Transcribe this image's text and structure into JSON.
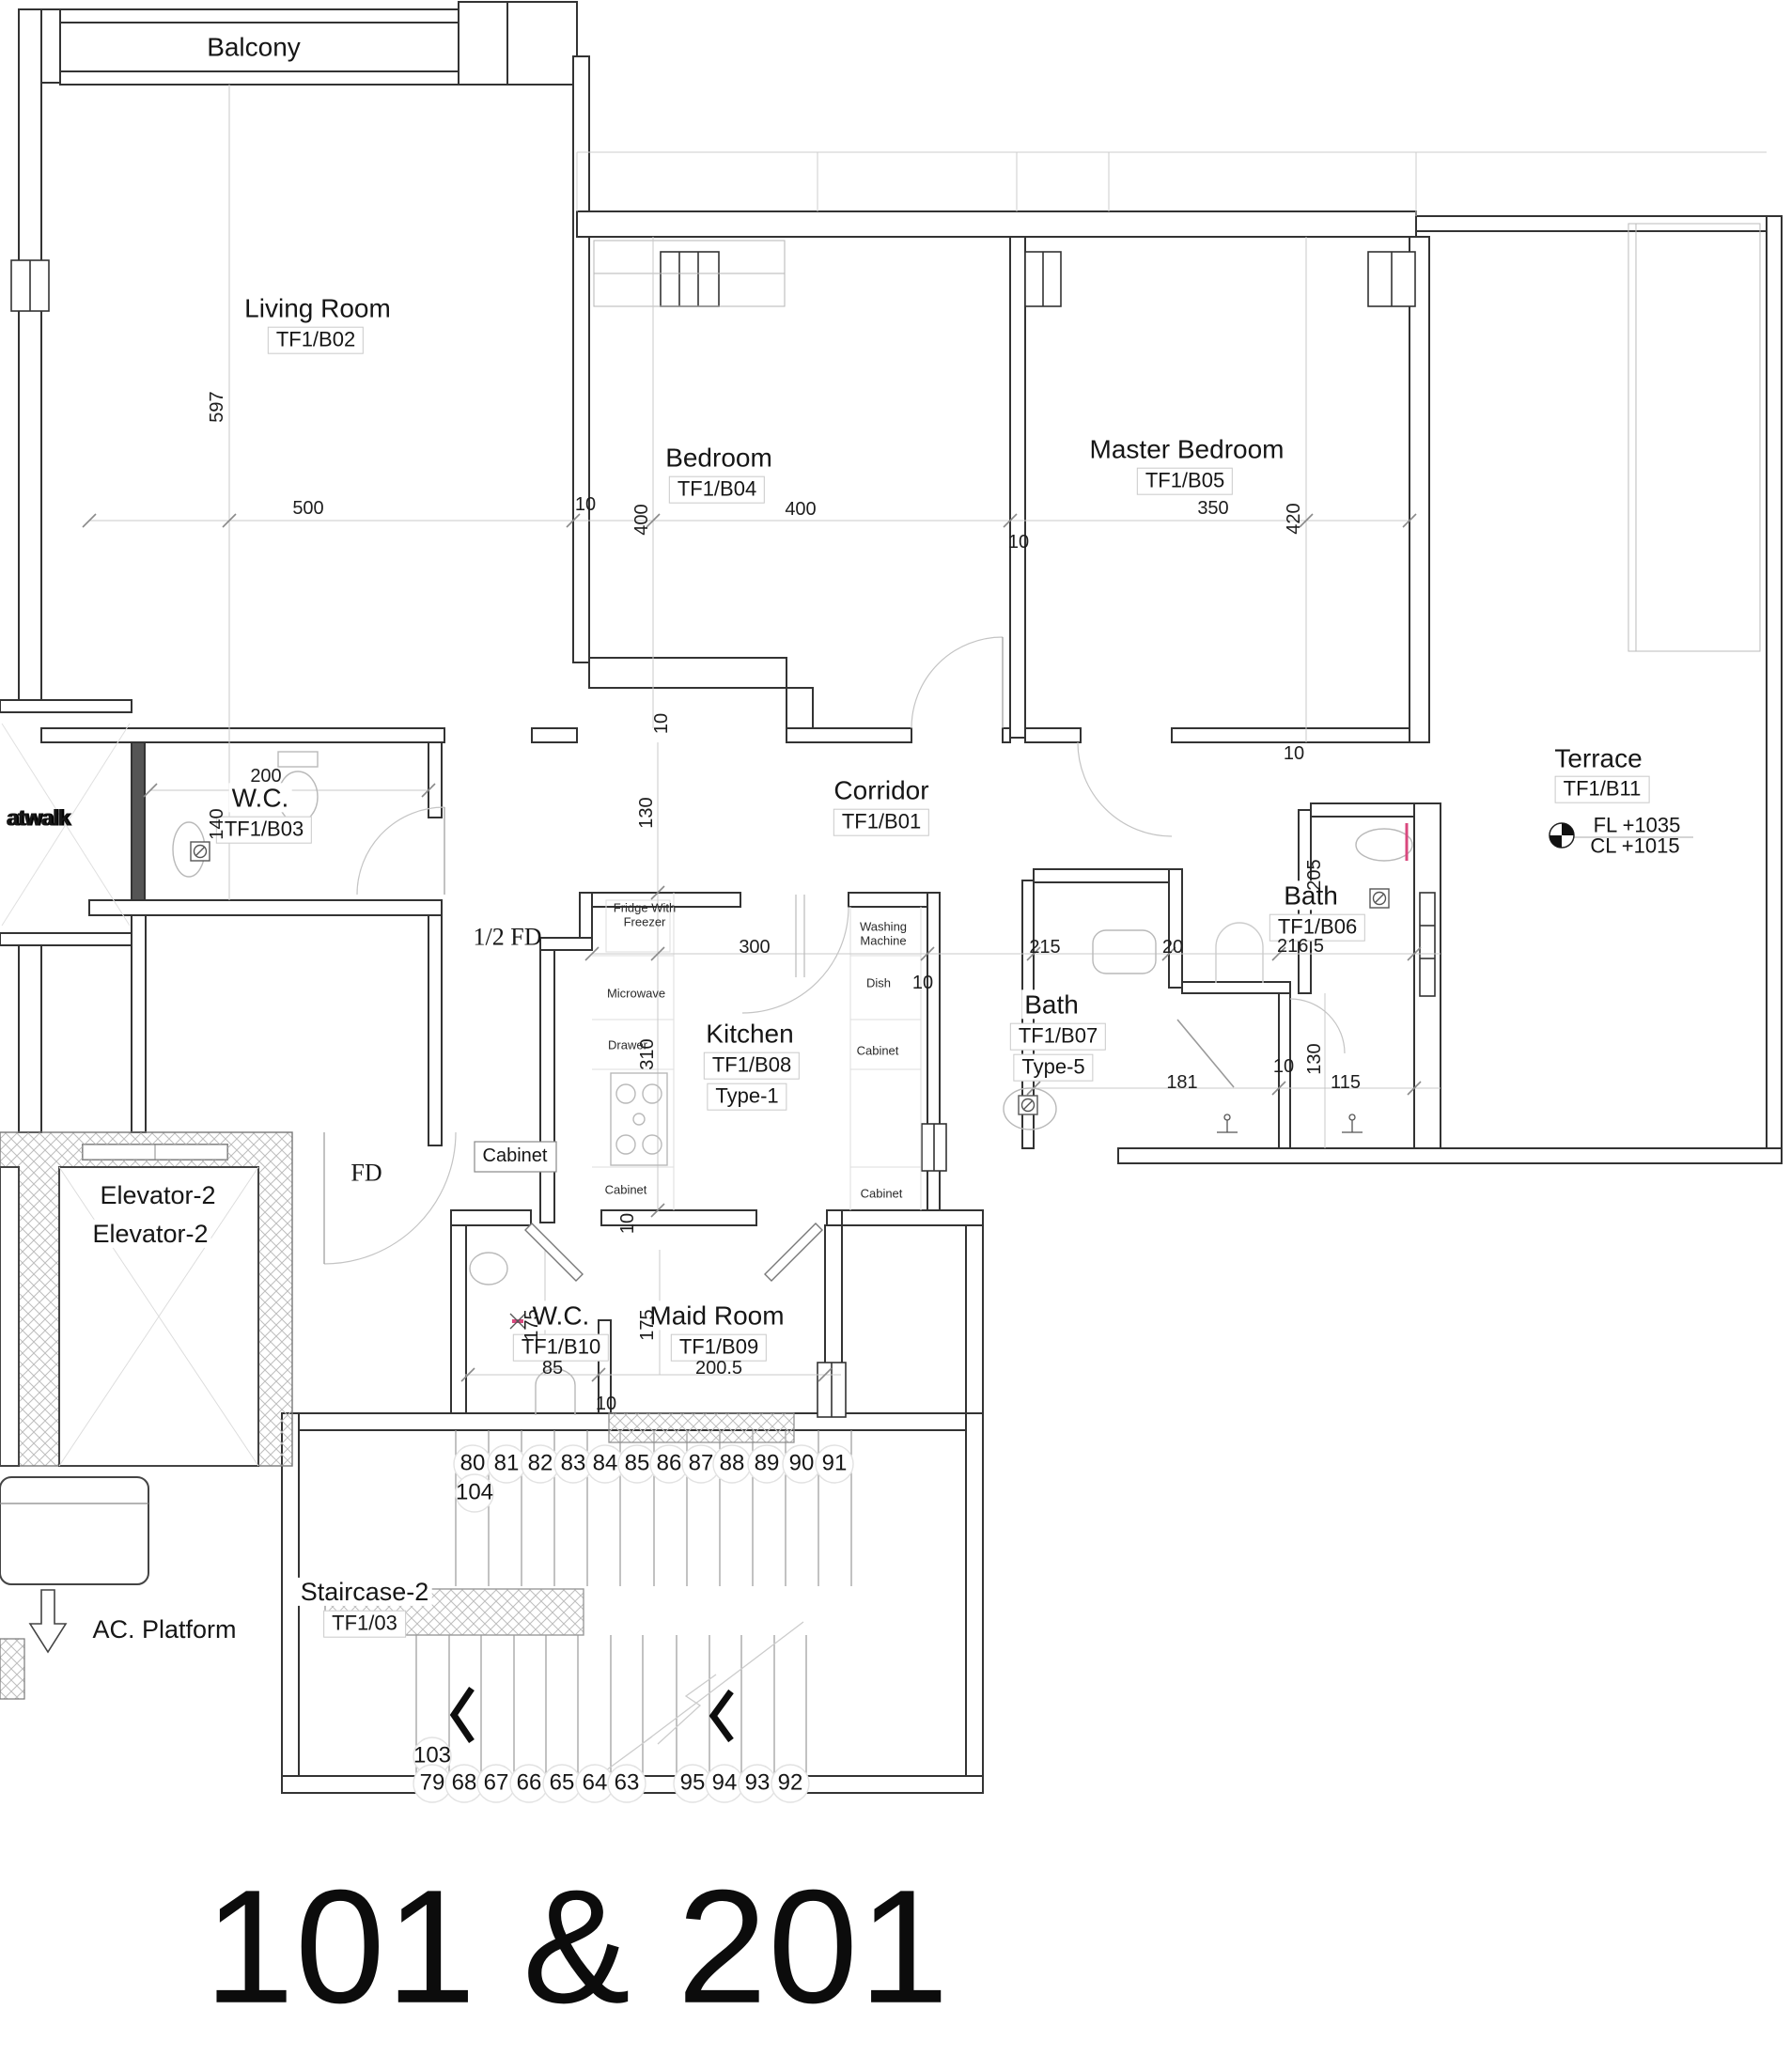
{
  "title": "101 & 201",
  "rooms": {
    "balcony": {
      "name": "Balcony"
    },
    "living": {
      "name": "Living Room",
      "code": "TF1/B02"
    },
    "bedroom": {
      "name": "Bedroom",
      "code": "TF1/B04"
    },
    "master": {
      "name": "Master Bedroom",
      "code": "TF1/B05"
    },
    "wc_b03": {
      "name": "W.C.",
      "code": "TF1/B03"
    },
    "corridor": {
      "name": "Corridor",
      "code": "TF1/B01"
    },
    "terrace": {
      "name": "Terrace",
      "code": "TF1/B11",
      "fl": "FL +1035",
      "cl": "CL +1015"
    },
    "bath_b06": {
      "name": "Bath",
      "code": "TF1/B06"
    },
    "bath_b07": {
      "name": "Bath",
      "code": "TF1/B07",
      "type": "Type-5"
    },
    "kitchen": {
      "name": "Kitchen",
      "code": "TF1/B08",
      "type": "Type-1"
    },
    "wc_b10": {
      "name": "W.C.",
      "code": "TF1/B10"
    },
    "maid": {
      "name": "Maid Room",
      "code": "TF1/B09"
    },
    "staircase": {
      "name": "Staircase-2",
      "code": "TF1/03"
    },
    "elevator": {
      "name": "Elevator-2",
      "name2": "Elevator-2"
    },
    "ac_platform": {
      "name": "AC. Platform"
    },
    "catwalk": {
      "name": "atwalk"
    }
  },
  "fixtures": {
    "fridge": "Fridge With Freezer",
    "microwave": "Microwave",
    "drawer": "Drawer",
    "cabinet_left": "Cabinet",
    "washing": "Washing Machine",
    "dish": "Dish",
    "cabinet_r1": "Cabinet",
    "cabinet_r2": "Cabinet",
    "cabinet_box": "Cabinet"
  },
  "dims": {
    "living_w": "500",
    "living_h": "597",
    "bed_wall": "10",
    "bed_h": "400",
    "bed_w": "400",
    "master_w": "350",
    "master_h": "420",
    "divider": "10",
    "wc_b03_w": "200",
    "wc_b03_h": "140",
    "corridor_h": "130",
    "wall10b": "10",
    "half_fd": "1/2 FD",
    "fd": "FD",
    "kitchen_w": "300",
    "kitchen_h": "310",
    "kitchen_wall": "10",
    "kitchen_wall2": "10",
    "bath7_w": "215",
    "bath_wall20": "20",
    "bath6_w": "216.5",
    "bath6_h": "205",
    "bath7_door": "181",
    "bath7_wall": "10",
    "bath7_h": "130",
    "bath_r": "115",
    "master_r": "10",
    "wc_b10_w": "85",
    "wc_b10_h": "175",
    "wc_b10_wall": "10",
    "maid_h": "175",
    "maid_w": "200.5"
  },
  "stairs": {
    "top": [
      "80",
      "81",
      "82",
      "83",
      "84",
      "85",
      "86",
      "87",
      "88",
      "89",
      "90",
      "91"
    ],
    "top_mark": "104",
    "bottom_mark": "103",
    "bottom_left": [
      "79",
      "68",
      "67",
      "66",
      "65",
      "64",
      "63"
    ],
    "bottom_right": [
      "95",
      "94",
      "93",
      "92"
    ]
  },
  "colors": {
    "wall": "#333333",
    "thin": "#c9c9c9",
    "hatch": "#bdbdbd",
    "shower_accent": "#d9487e"
  }
}
